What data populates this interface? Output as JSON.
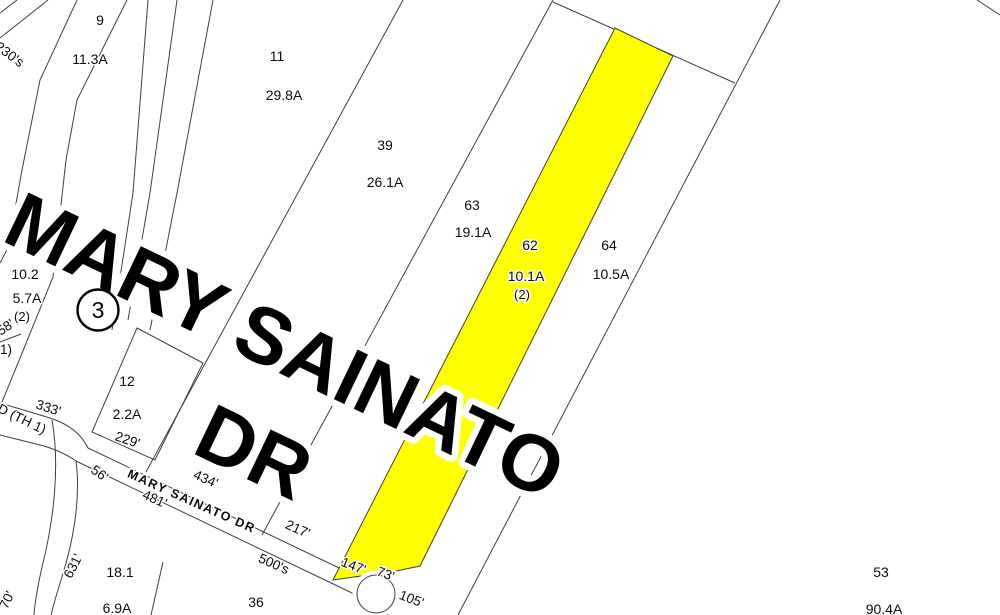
{
  "map": {
    "highlight_color": "#ffff00",
    "line_color": "#3f3f3f",
    "giant_road_label": {
      "line1": "MARY SAINATO",
      "line2": "DR"
    },
    "street_label": "MARY SAINATO DR",
    "old_road_label": "D (TH 1)",
    "route_shield": "3",
    "parcels": [
      {
        "number": "9",
        "area": "11.3A"
      },
      {
        "number": "11",
        "area": "29.8A"
      },
      {
        "number": "39",
        "area": "26.1A"
      },
      {
        "number": "63",
        "area": "19.1A"
      },
      {
        "number": "62",
        "area": "10.1A",
        "units": "(2)",
        "highlighted": true
      },
      {
        "number": "64",
        "area": "10.5A"
      },
      {
        "number": "10.2",
        "area": "5.7A",
        "units": "(2)"
      },
      {
        "number": "12",
        "area": "2.2A"
      },
      {
        "number": "18.1",
        "area": "6.9A"
      },
      {
        "number": "36",
        "area": ""
      },
      {
        "number": "53",
        "area": "90.4A"
      }
    ],
    "measurements": {
      "nw_addresses": "230's",
      "m58": "58'",
      "m1": "1)",
      "m333": "333'",
      "m229": "229'",
      "m434": "434'",
      "m481": "481'",
      "m56": "56'",
      "m631": "631'",
      "m70": "70'",
      "m217": "217'",
      "m500s": "500's",
      "m147": "147'",
      "m73": "73'",
      "m105": "105'"
    }
  }
}
